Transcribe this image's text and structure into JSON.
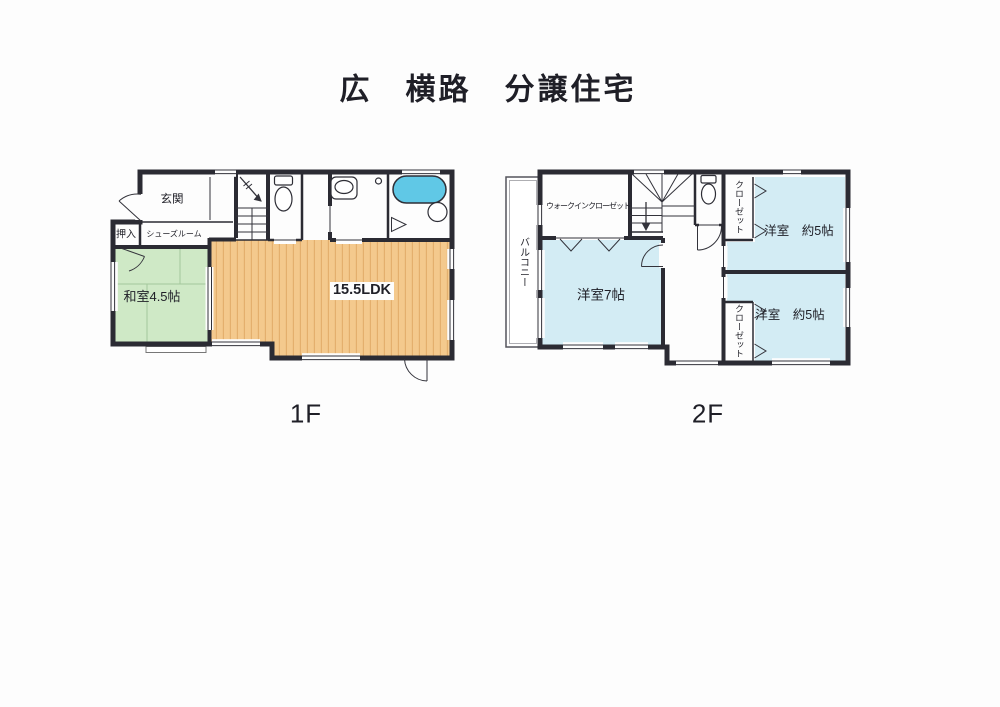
{
  "title": "広　横路　分譲住宅",
  "floors": {
    "f1": {
      "label": "1F",
      "rooms": {
        "genkan": "玄関",
        "oshiire": "押入",
        "shoes_room": "シューズルーム",
        "washitsu": "和室4.5帖",
        "ldk": "15.5LDK"
      }
    },
    "f2": {
      "label": "2F",
      "rooms": {
        "balcony": "バルコニー",
        "wic": "ウォークインクローゼット",
        "yoshitsu7": "洋室7帖",
        "closet_top": "クローゼット",
        "closet_bottom": "クローゼット",
        "yoshitsu5_top": "洋室　約5帖",
        "yoshitsu5_bottom": "洋室　約5帖"
      }
    }
  },
  "colors": {
    "wall": "#2b2b33",
    "ldk_floor": "#f4c98d",
    "ldk_stripe": "#e4af6d",
    "washitsu_floor": "#cfe9c6",
    "yoshitsu_floor": "#d3ecf4",
    "bathtub": "#60c8e6",
    "text": "#1f1f27"
  }
}
